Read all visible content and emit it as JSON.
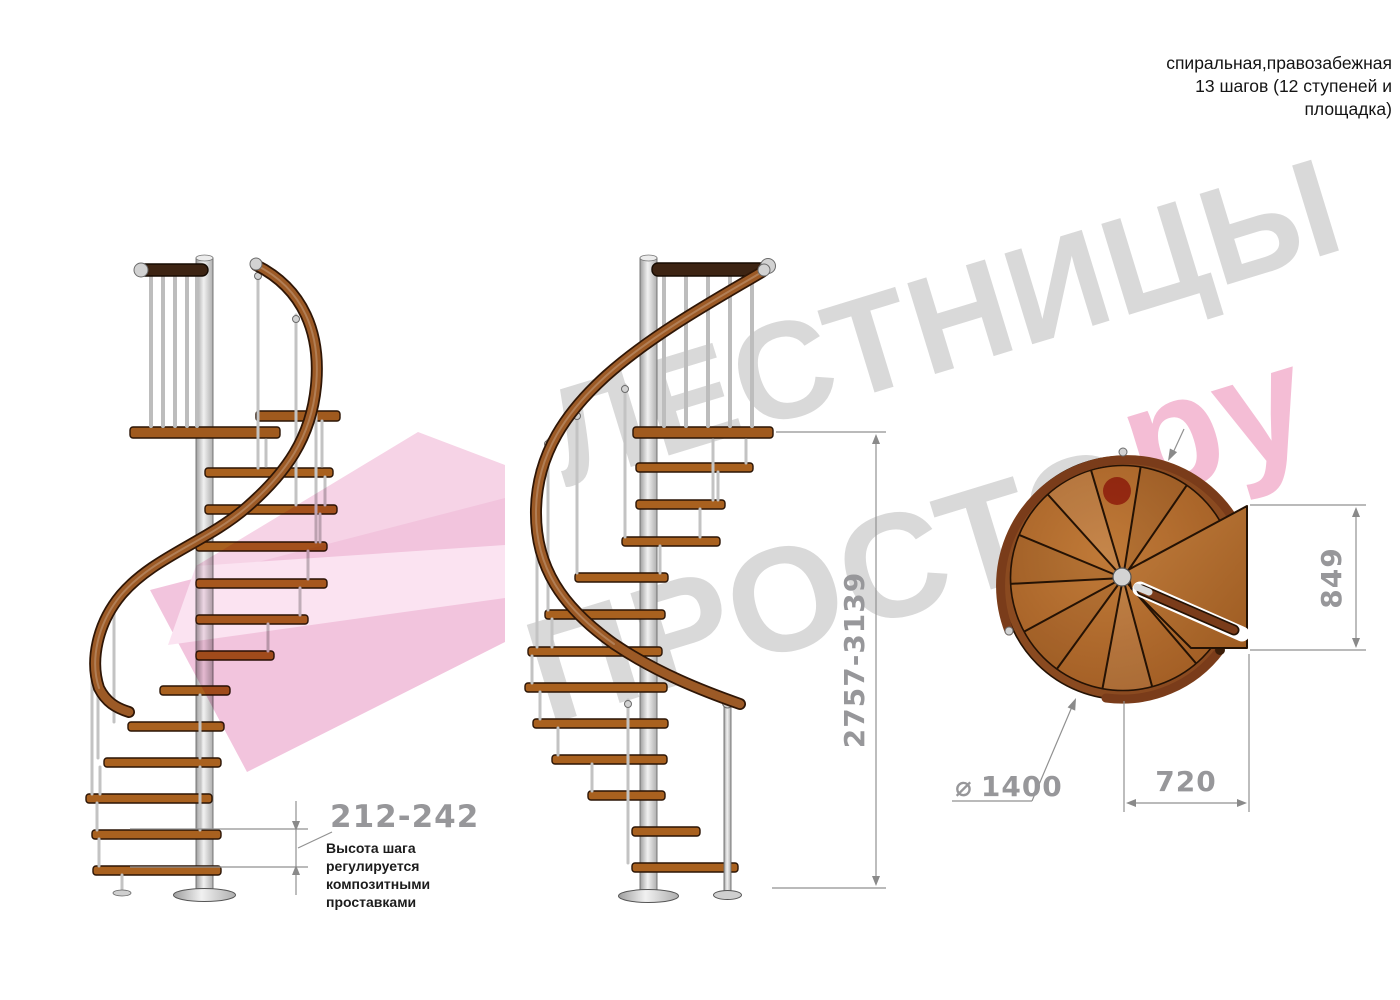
{
  "title": {
    "line1": "спиральная,правозабежная",
    "line2": "13 шагов (12 ступеней и",
    "line3": "площадка)"
  },
  "watermark": {
    "word_top": "ЛЕСТНИЦЫ",
    "word_bottom": "ПРОСТО",
    "suffix": "ру"
  },
  "dimensions": {
    "step_height": "212-242",
    "step_height_note_lines": [
      "Высота шага",
      "регулируется",
      "композитными",
      "проставками"
    ],
    "total_height": "2757-3139",
    "platform_depth": "849",
    "platform_width": "720",
    "diameter_symbol": "⌀",
    "diameter_value": "1400"
  },
  "colors": {
    "watermark_gray": "#d9d9d9",
    "watermark_pink": "#f4bdd5",
    "logo_dot_red": "#c6342e",
    "ribbon_pink": "#f4cce0",
    "wood_step": "#a9611f",
    "wood_rim": "#8a4a20",
    "handrail_brown": "#9c5a26",
    "dark_rail": "#3d2413",
    "metal_gray": "#d8d8d8",
    "dimension_gray": "#919191",
    "note_black": "#1c1c1c"
  }
}
